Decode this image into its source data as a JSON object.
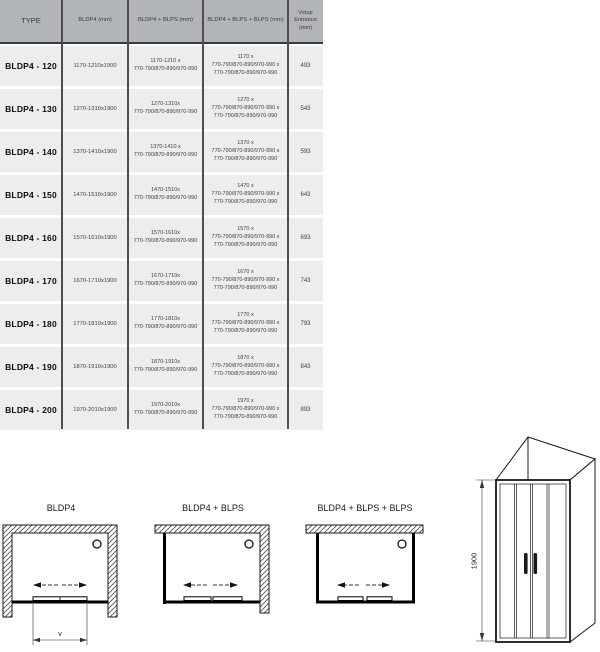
{
  "table": {
    "headers": {
      "type": "TYPE",
      "col2": "BLDP4 (mm)",
      "col3": "BLDP4 + BLPS (mm)",
      "col4": "BLDP4 + BLPS + BLPS (mm)",
      "col5": "Vstup\nEntrance\n(mm)"
    },
    "rows": [
      {
        "type": "BLDP4 - 120",
        "c2": "1170-1210x1900",
        "c3": "1170-1210 x\n770-790/870-890/970-990",
        "c4": "1170 x\n770-790/870-890/970-990 x\n770-790/870-890/970-990",
        "c5": "493"
      },
      {
        "type": "BLDP4 - 130",
        "c2": "1270-1310x1900",
        "c3": "1270-1310x\n770-790/870-890/970-990",
        "c4": "1270 x\n770-790/870-890/970-990 x\n770-790/870-890/970-990",
        "c5": "543"
      },
      {
        "type": "BLDP4 - 140",
        "c2": "1370-1410x1900",
        "c3": "1370-1410 x\n770-790/870-890/970-990",
        "c4": "1370 x\n770-790/870-890/970-990 x\n770-790/870-890/970-990",
        "c5": "593"
      },
      {
        "type": "BLDP4 - 150",
        "c2": "1470-1510x1900",
        "c3": "1470-1510x\n770-790/870-890/970-990",
        "c4": "1470 x\n770-790/870-890/970-990 x\n770-790/870-890/970-990",
        "c5": "643"
      },
      {
        "type": "BLDP4 - 160",
        "c2": "1570-1610x1900",
        "c3": "1570-1610x\n770-790/870-890/970-990",
        "c4": "1570 x\n770-790/870-890/970-990 x\n770-790/870-890/970-990",
        "c5": "693"
      },
      {
        "type": "BLDP4 - 170",
        "c2": "1670-1710x1900",
        "c3": "1670-1710x\n770-790/870-890/970-990",
        "c4": "1670 x\n770-790/870-890/970-990 x\n770-790/870-890/970-990",
        "c5": "743"
      },
      {
        "type": "BLDP4 - 180",
        "c2": "1770-1810x1900",
        "c3": "1770-1810x\n770-790/870-890/970-990",
        "c4": "1770 x\n770-790/870-890/970-990 x\n770-790/870-890/970-990",
        "c5": "793"
      },
      {
        "type": "BLDP4 - 190",
        "c2": "1870-1910x1900",
        "c3": "1870-1910x\n770-790/870-890/970-990",
        "c4": "1870 x\n770-790/870-890/970-990 x\n770-790/870-890/970-990",
        "c5": "843"
      },
      {
        "type": "BLDP4 - 200",
        "c2": "1970-2010x1900",
        "c3": "1970-2010x\n770-790/870-890/970-990",
        "c4": "1970 x\n770-790/870-890/970-990 x\n770-790/870-890/970-990",
        "c5": "893"
      }
    ]
  },
  "diagrams": {
    "d1_label": "BLDP4",
    "d2_label": "BLDP4 + BLPS",
    "d3_label": "BLDP4 + BLPS + BLPS",
    "dim_v_label": "v",
    "height_label": "1900"
  },
  "colors": {
    "header_bg": "#b2b5b8",
    "cell_bg": "#ecedee",
    "border_dark": "#4e4e50",
    "line_black": "#111111"
  }
}
